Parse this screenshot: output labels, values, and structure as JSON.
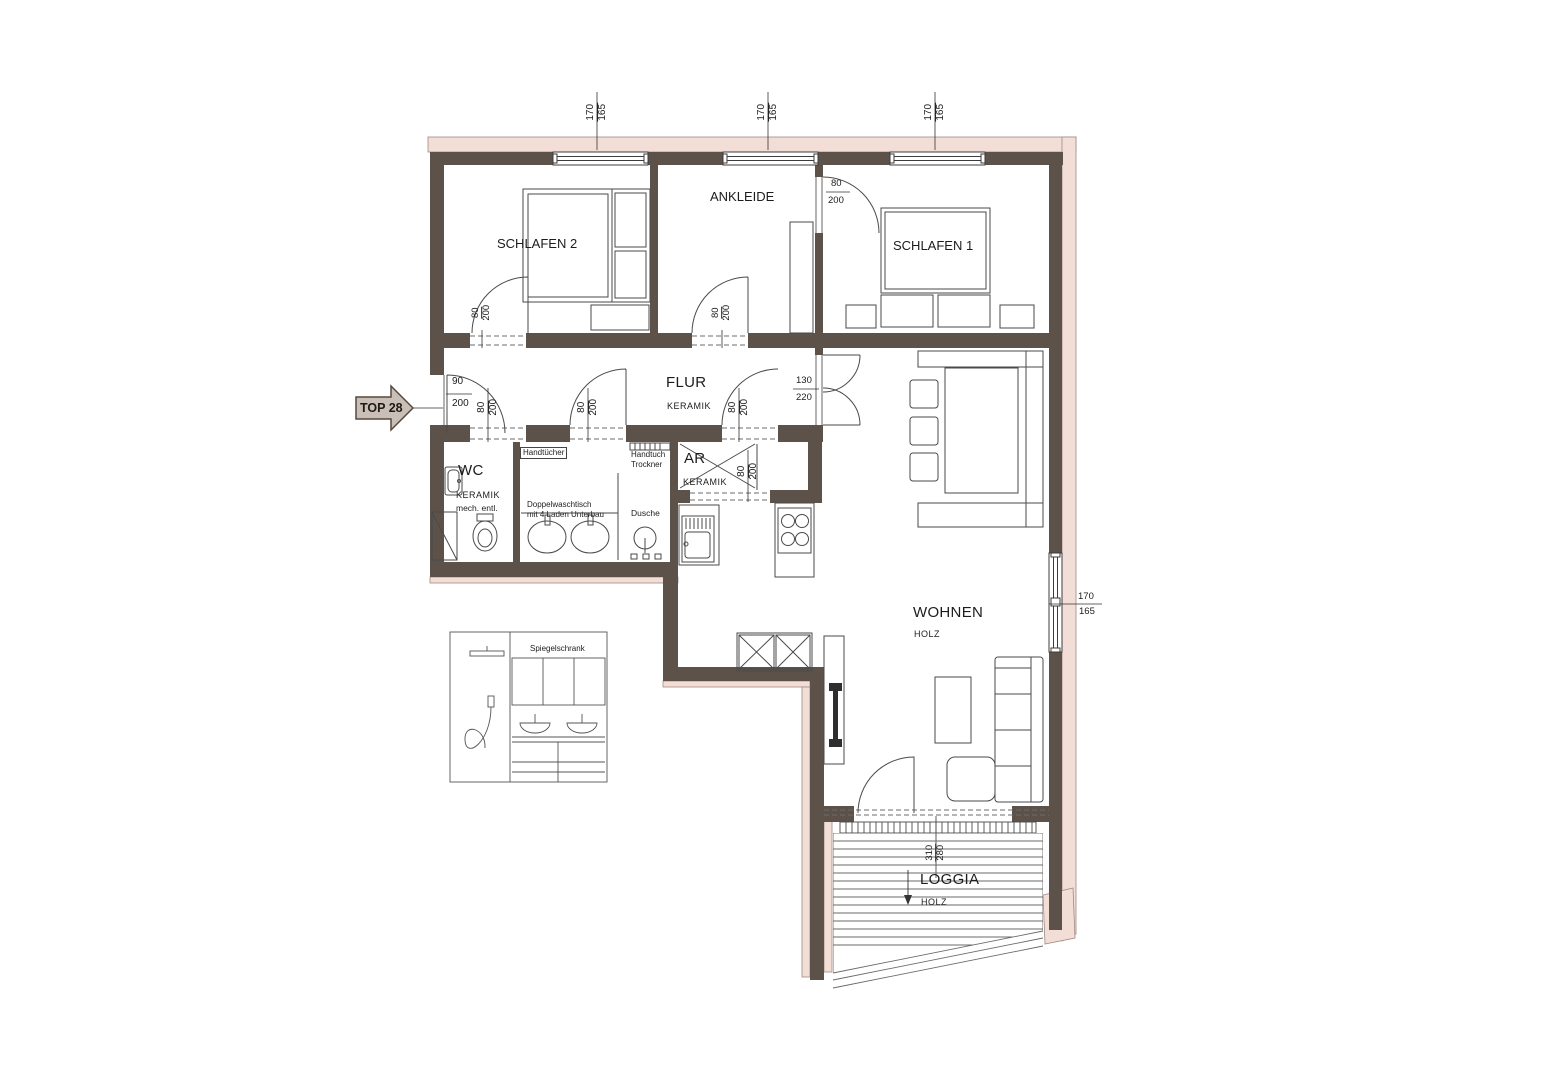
{
  "plan": {
    "entrance_marker": "TOP 28",
    "rooms": {
      "schlafen2": {
        "name": "SCHLAFEN 2"
      },
      "ankleide": {
        "name": "ANKLEIDE"
      },
      "schlafen1": {
        "name": "SCHLAFEN 1"
      },
      "flur": {
        "name": "FLUR",
        "floor": "KERAMIK"
      },
      "wc": {
        "name": "WC",
        "floor": "KERAMIK",
        "note": "mech. entl."
      },
      "ar": {
        "name": "AR",
        "floor": "KERAMIK"
      },
      "wohnen": {
        "name": "WOHNEN",
        "floor": "HOLZ"
      },
      "loggia": {
        "name": "LOGGIA",
        "floor": "HOLZ"
      }
    },
    "fixtures": {
      "handtuecher": "Handtücher",
      "handtuch_trockner_line1": "Handtuch",
      "handtuch_trockner_line2": "Trockner",
      "doppelwaschtisch_line1": "Doppelwaschtisch",
      "doppelwaschtisch_line2": "mit 4 Laden Unterbau",
      "dusche": "Dusche",
      "spiegelschrank": "Spiegelschrank"
    },
    "dims": {
      "win_w": "170",
      "win_h": "165",
      "door_w": "80",
      "door_h": "200",
      "entry_w": "90",
      "entry_h": "200",
      "dbl_w": "130",
      "dbl_h": "220",
      "loggia_w": "310",
      "loggia_h": "280"
    },
    "colors": {
      "wall": "#5d5249",
      "insulation": "#f2ded7"
    }
  }
}
